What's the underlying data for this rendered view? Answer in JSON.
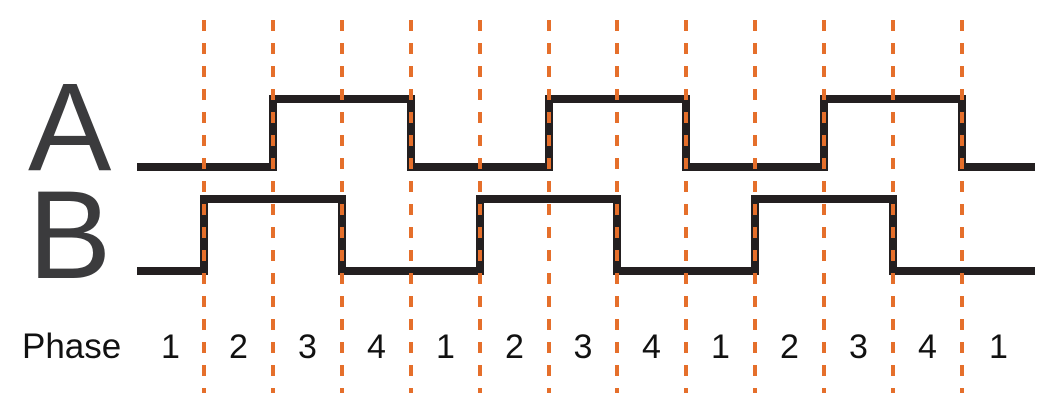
{
  "labels": {
    "phase": "Phase"
  },
  "signals": [
    {
      "label": "A",
      "levels": [
        0,
        0,
        1,
        1,
        0,
        0,
        1,
        1,
        0,
        0,
        1,
        1,
        0
      ]
    },
    {
      "label": "B",
      "levels": [
        0,
        1,
        1,
        0,
        0,
        1,
        1,
        0,
        0,
        1,
        1,
        0,
        0
      ]
    }
  ],
  "phase_numbers": [
    "1",
    "2",
    "3",
    "4",
    "1",
    "2",
    "3",
    "4",
    "1",
    "2",
    "3",
    "4",
    "1"
  ],
  "colors": {
    "dash": "#E56F2B",
    "waveform": "#231F20",
    "signal_label": "#3B3B3D",
    "text": "#111111",
    "background": "#FFFFFF"
  },
  "diagram": {
    "x_start": 137,
    "x_end": 1035,
    "boundaries_x": [
      204,
      273,
      342,
      411,
      480,
      549,
      617,
      686,
      755,
      824,
      893,
      962
    ],
    "signal_y": [
      {
        "high": 99,
        "low": 167
      },
      {
        "high": 199,
        "low": 271
      }
    ],
    "dash_top": 20,
    "dash_height": 373,
    "stroke_width": 8
  }
}
